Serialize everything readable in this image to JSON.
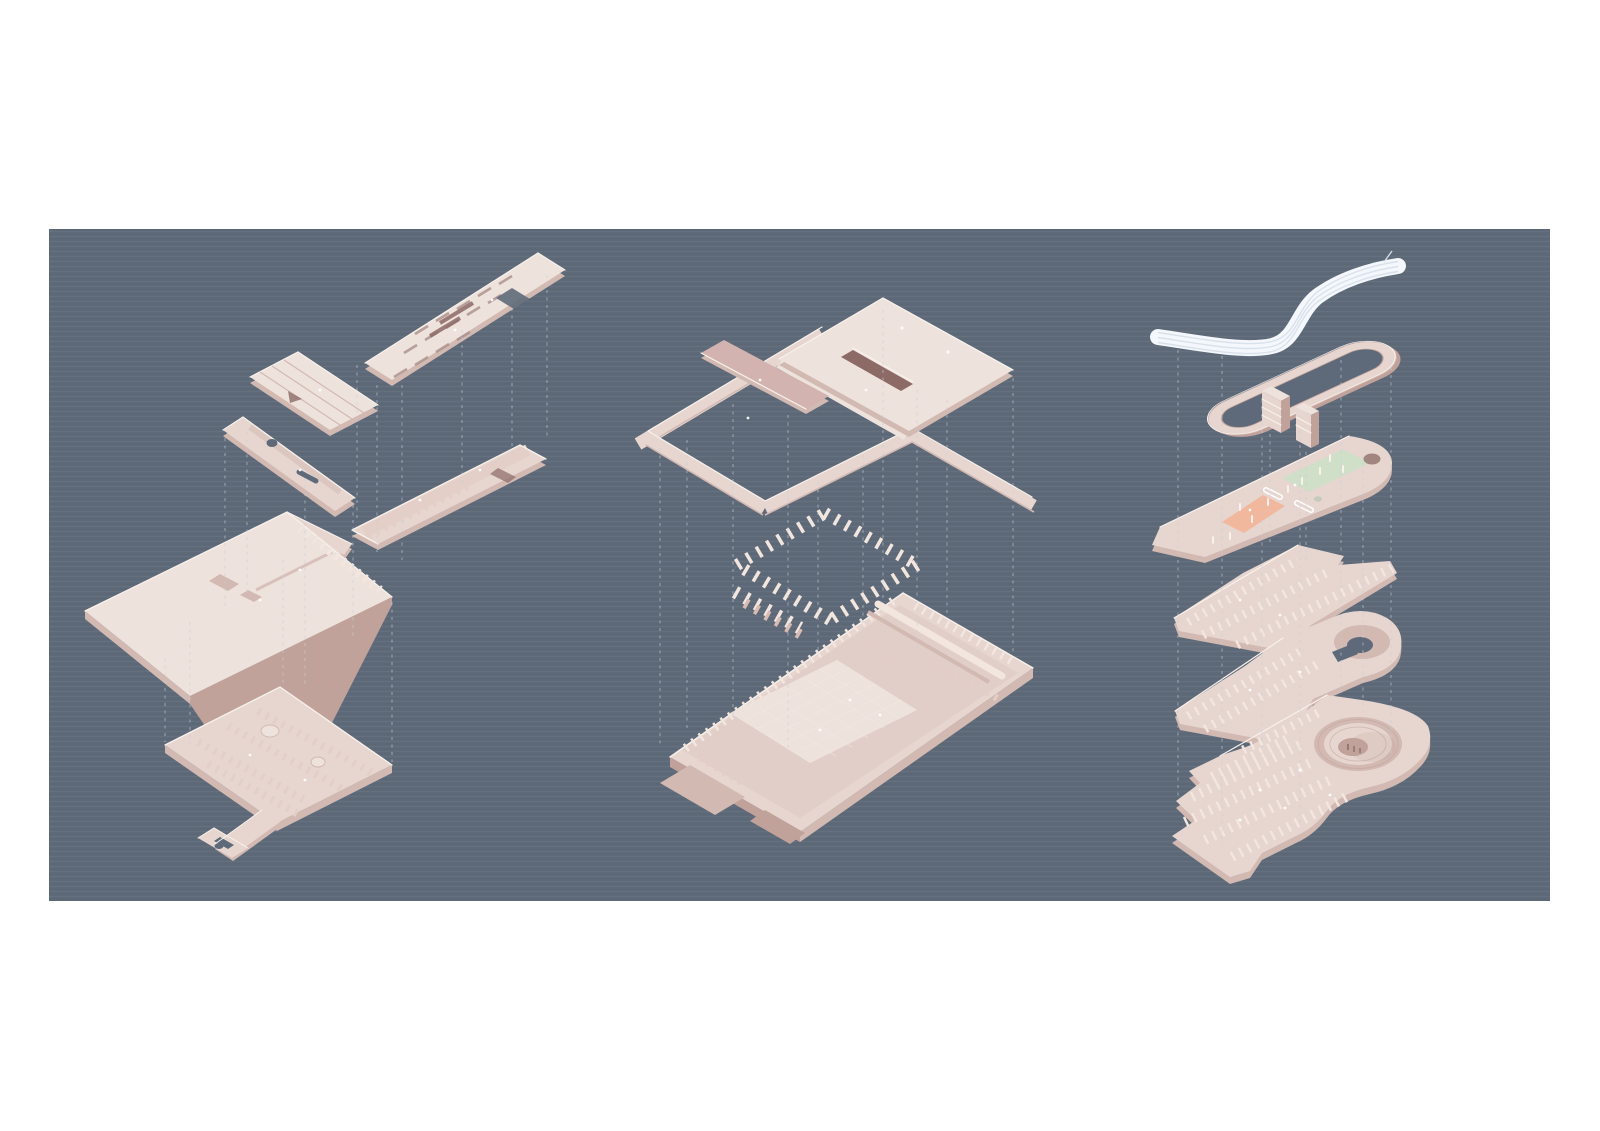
{
  "figure": {
    "kind": "exploded axonometric architectural diagram",
    "description": "Three pale-pink exploded axonometric building studies floating over a slate-blue panel on a white page, their layers aligned by vertical dashed guide lines.",
    "models": [
      {
        "position": "left",
        "layers": [
          "slatted roof plate with square opening",
          "ribbed roof plate with notch",
          "narrow gallery bar with oculus and slot",
          "long gallery wing with partitions and end opening",
          "plaza slab with entry blocks",
          "lower floor plate with partition field, round rooms and hooked ramp arm"
        ]
      },
      {
        "position": "middle",
        "layers": [
          "roof plane with courtyard opening, dark skylight slot and diagonal crossing ramp",
          "floating diamond ring of columns",
          "podium slab with gridded courtyard, perimeter walls and rooftop ducts"
        ]
      },
      {
        "position": "right",
        "layers": [
          "white curved canopy ribbon",
          "racetrack circulation loop",
          "two slatted service cores",
          "program plate with green and salmon zones and pill openings",
          "column-field plate",
          "column-field plate with circular drum void",
          "ground plate with spiral rotunda and column field"
        ]
      }
    ]
  },
  "colors": {
    "page_bg": "#ffffff",
    "panel_bg": "#5e6a79",
    "model_base": "#e7d6d0",
    "model_light": "#eee2dc",
    "model_side": "#d2b9b2",
    "model_side_dark": "#c0a29b",
    "model_mauve": "#d2b3af",
    "partition_pink": "#e3cfc8",
    "slot_dark": "#8c6a66",
    "edge_white": "#f8f1ec",
    "ribbon_white": "#f4f7fb",
    "ribbon_line": "#d7dfea",
    "accent_green": "#cfdfc8",
    "accent_salmon": "#f1b89e",
    "tick_light": "#f2e6df",
    "tick_shadow": "#d8bcb4",
    "guide_line": "#c6cfd8",
    "grid_line": "#f4e9e3",
    "detail_dark": "#a98f8a",
    "light_dot": "#ffffff"
  }
}
